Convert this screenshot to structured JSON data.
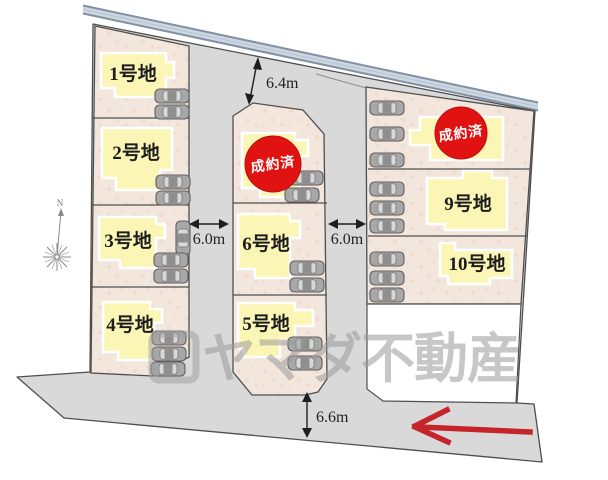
{
  "plan_type": "residential-lot-site-plan",
  "lots": [
    {
      "label": "1号地"
    },
    {
      "label": "2号地"
    },
    {
      "label": "3号地"
    },
    {
      "label": "4号地"
    },
    {
      "label": "5号地"
    },
    {
      "label": "6号地"
    },
    {
      "label": "9号地"
    },
    {
      "label": "10号地"
    }
  ],
  "sold_overlays": [
    {
      "label": "成約済"
    },
    {
      "label": "成約済"
    }
  ],
  "dimensions": {
    "top_setback": "6.4m",
    "west_road": "6.0m",
    "east_road": "6.0m",
    "south_road": "6.6m"
  },
  "compass": {
    "north": "N"
  },
  "watermark": {
    "text": "ヤマダ不動産"
  },
  "colors": {
    "lot_fill": "#f3e6dc",
    "road_fill": "#d9d9d9",
    "building_fill": "#fbf5b6",
    "building_outline": "#ffffff",
    "boundary_band": "#cdd7e1",
    "boundary_band_line": "#8091a3",
    "sold_circle": "#e01212",
    "red_arrow": "#c5242b",
    "watermark_gray": "#9b9b9b"
  }
}
